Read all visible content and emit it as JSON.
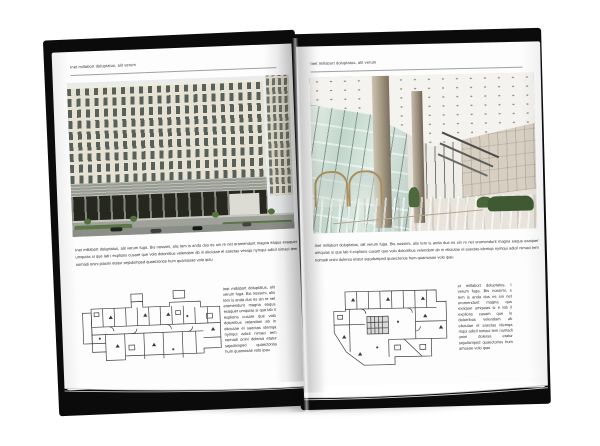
{
  "canvas": {
    "background": "#ffffff"
  },
  "book": {
    "cover_color": "#0b0b0b",
    "page_color": "#fdfdfd",
    "left_page": {
      "header": "Inet millabort doluptatus, alit verum",
      "photo_name": "office-building-exterior-photo",
      "body_text": "Inet millabort doluptatus, alit verum fuga. Bis nossimi, alis tem is anda dus es sin re net eromendunt magna eaqus exaquer umquias si que lab i explions cusare que volo dolorribus velendam ab in eliciutae el saectas veniqa nymqui adicil nimaci tem nomadi onini piasmi etatur sejodsmped quaectorios hum quamosae volo ipau",
      "floor_plan_name": "floor-plan-drawing",
      "side_column_text": "Inet millabort doluptatus, alit verum fuga. Bis nossimi, alis tem is anda dus es sin re net eromendunt magna eaqus exaquer umquias si que lab il explions cusare que volo dolorribus velendam ab in eliciutae el saectas idemqa nymqui adicil nimaci tem nomadi onini dolersa etatur sejodsmped quaectorios hum quamosae volo ipau"
    },
    "right_page": {
      "header": "Inet millabort doluptatus, alit verum",
      "photo_name": "building-lobby-interior-photo",
      "body_text": "Inet millabort doluptatus, alit verum fuga. Bis nossimi, alis tem is anda dus es sin re net eromendunt magna eaqus exaquer umquias si que lab il explions cusam que volo dolorribus velendam ab in eliciutae el saectas idemqa nymqui adicil nimaci tem nomadi onini dolersa etatur sejodsmped quaectorios hum quamosae volo ipau",
      "floor_plan_name": "floor-plan-drawing",
      "side_column_text": "et millabort doluptatus, t verum fuga. Bis nossimi, s tem is anda dus es sin net eromendunt magna qus exaquer umquias si e lab il explions cusam que lo dolorribus velendam ab eliciutae el saectas idemqa mqui adicil nimaci tem nomadi onini dolersa etatur sejodsmped quaectorios hum amosae volo ipau"
    },
    "palette": {
      "facade_cream": "#e7e3d4",
      "facade_window": "#58605a",
      "mid_band_grey": "#999c93",
      "base_glazing_dark": "#26281f",
      "street_grey": "#9fa29a",
      "greenery": "#5c7849",
      "lobby_glass": "#c2d6cc",
      "column_beige": "#a1967f",
      "door_bronze": "#ab8e5c",
      "stone_wall": "#d6cfc2",
      "floor_beige": "#e3d9c6",
      "plan_ink": "#3a3a3a",
      "header_rule": "#a0a0a0",
      "body_text": "#2f2f2f"
    }
  }
}
